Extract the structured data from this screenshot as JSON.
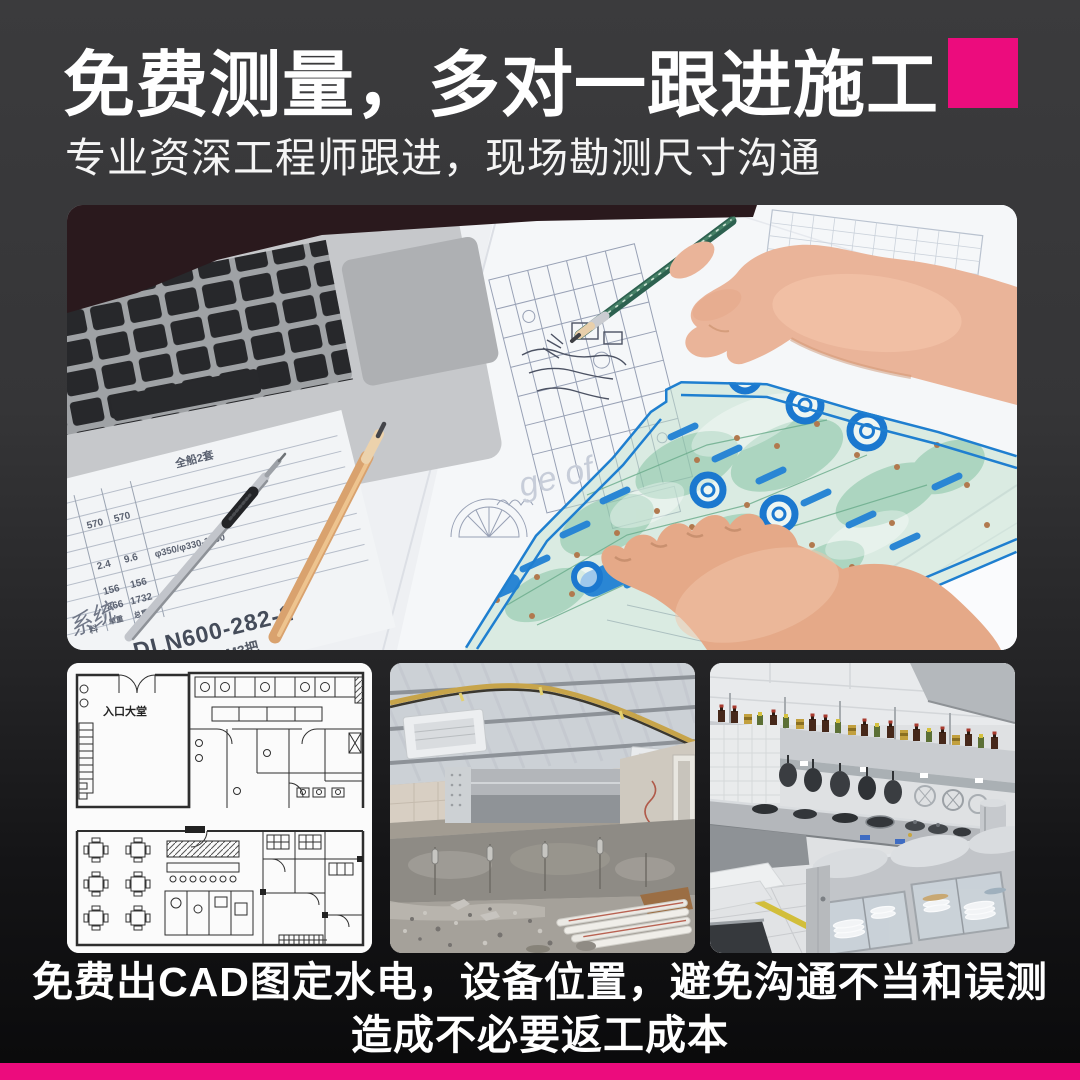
{
  "page": {
    "background_top": "#3b3b3d",
    "background_bottom": "#0a0a0b",
    "accent_pink": "#ec0c7d",
    "text_color": "#ffffff"
  },
  "header": {
    "title": "免费测量，多对一跟进施工",
    "subtitle": "专业资深工程师跟进，现场勘测尺寸沟通"
  },
  "hero_photo": {
    "description": "engineer hands drawing on blueprints with laptop, pencils and blue drafting stencil",
    "watermark": "ge of",
    "paper_table": {
      "header": "全船2套",
      "col1": [
        "570",
        "2.4",
        "156",
        "866",
        "单重"
      ],
      "col2": [
        "570",
        "9.6",
        "156",
        "1732",
        "总重"
      ],
      "spec": "φ350/φ330-1500",
      "material_label": "料",
      "part_no": "DLN600-282-1",
      "system_note": "系统",
      "bottom_note": "6000M3把"
    }
  },
  "gallery": {
    "floor_plan_label": "入口大堂"
  },
  "caption": {
    "line1": "免费出CAD图定水电，设备位置，避免沟通不当和误测",
    "line2": "造成不必要返工成本"
  }
}
